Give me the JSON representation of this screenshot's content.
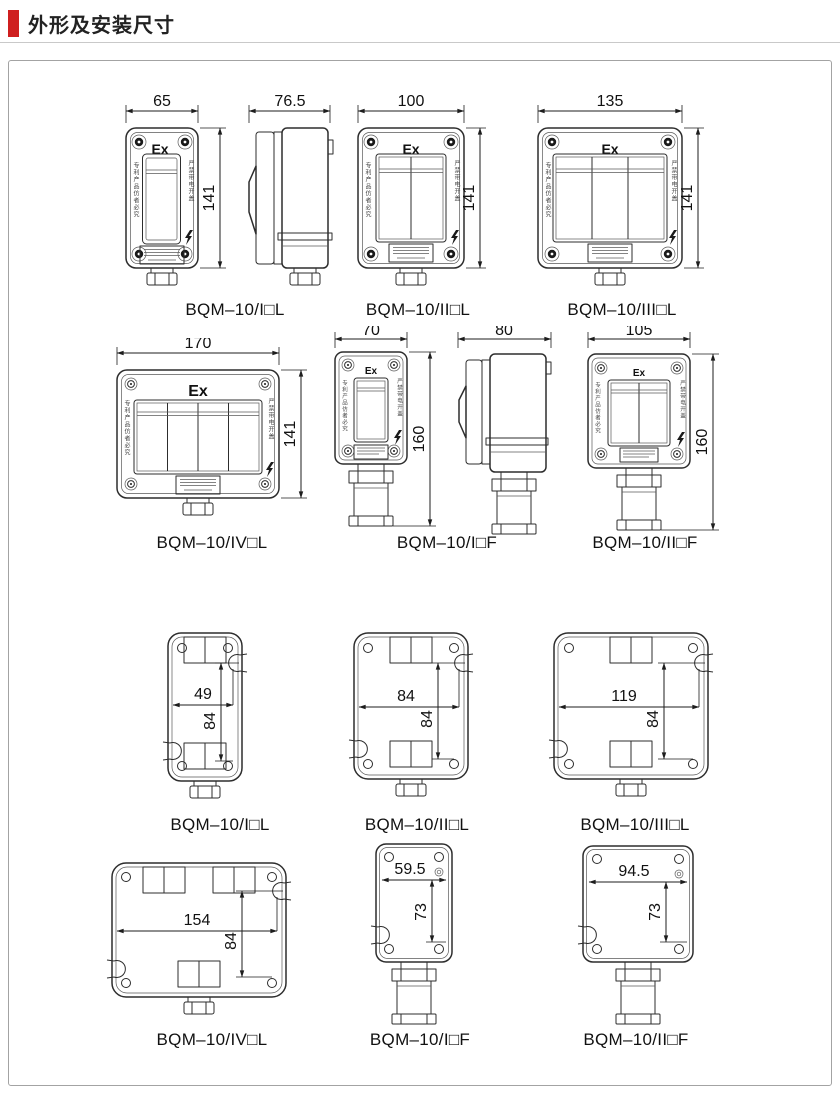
{
  "page": {
    "title": "外形及安装尺寸"
  },
  "shared": {
    "ex": "Ex",
    "side_left": "专利产品仿者必究",
    "side_right": "严禁带电开盖"
  },
  "figures": {
    "front1": {
      "model": "BQM–10/I□L",
      "top_dim": "65",
      "height_dim": "141"
    },
    "side1": {
      "top_dim": "76.5"
    },
    "front2": {
      "model": "BQM–10/II□L",
      "top_dim": "100",
      "height_dim": "141"
    },
    "front3": {
      "model": "BQM–10/III□L",
      "top_dim": "135",
      "height_dim": "141"
    },
    "front4": {
      "model": "BQM–10/IV□L",
      "top_dim": "170",
      "height_dim": "141"
    },
    "frontF1": {
      "model": "BQM–10/I□F",
      "top_dim": "70",
      "height_dim": "160"
    },
    "sideF1": {
      "top_dim": "80"
    },
    "frontF2": {
      "model": "BQM–10/II□F",
      "top_dim": "105",
      "height_dim": "160"
    },
    "back1": {
      "model": "BQM–10/I□L",
      "width_dim": "49",
      "height_dim": "84"
    },
    "back2": {
      "model": "BQM–10/II□L",
      "width_dim": "84",
      "height_dim": "84"
    },
    "back3": {
      "model": "BQM–10/III□L",
      "width_dim": "119",
      "height_dim": "84"
    },
    "back4": {
      "model": "BQM–10/IV□L",
      "width_dim": "154",
      "height_dim": "84"
    },
    "backF1": {
      "model": "BQM–10/I□F",
      "width_dim": "59.5",
      "height_dim": "73"
    },
    "backF2": {
      "model": "BQM–10/II□F",
      "width_dim": "94.5",
      "height_dim": "73"
    }
  }
}
